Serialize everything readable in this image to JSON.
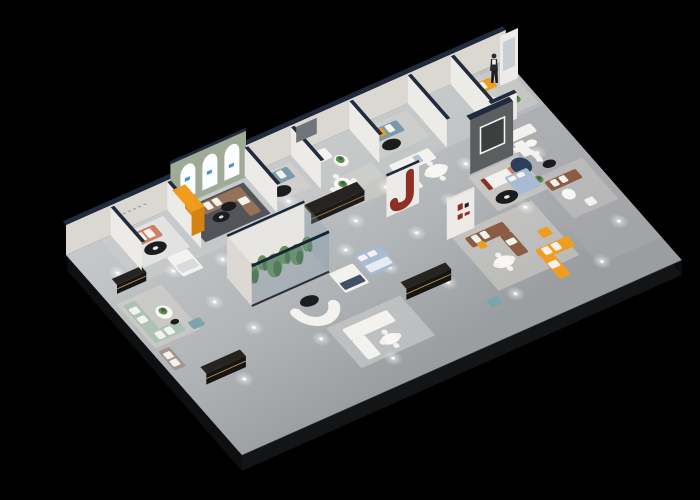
{
  "canvas": {
    "width": 700,
    "height": 500,
    "background": "#000000"
  },
  "scene_type": "3d-isometric-furniture-showroom-floor-plan",
  "palette": {
    "floor": "#b3b6b8",
    "floor_light": "#ced1d1",
    "floor_dark": "#9b9ea1",
    "slab_edge": "#121416",
    "slab_top_line": "#34383c",
    "wall_face": "#dbd8d2",
    "wall_bright": "#edebe7",
    "wall_cap_navy": "#202b3d",
    "wall_cap_light": "#e6e3de",
    "sage_wall": "#9fab97",
    "arch_white": "#fcfdff",
    "arch_logo_blue": "#2e7fc2",
    "glass": "rgba(136,158,173,0.30)",
    "glass_dark": "rgba(90,110,125,0.45)",
    "glass_cap_navy": "#182539",
    "glass_highlight": "#d8e6ee",
    "orange": "#f09c1e",
    "coral": "#cf7f63",
    "mauve": "#a5948b",
    "brown": "#96715a",
    "leather_brown": "#8a5d42",
    "steel_blue": "#7b9aa9",
    "sage_green": "#abc2b4",
    "teal": "#7aa6ab",
    "navy_table": "#2d3e5a",
    "red_accent": "#8e2f26",
    "dark_wood": "#262320",
    "gold_trim": "#c9a14d",
    "white_fabric": "#f3f2ef",
    "cushion_white": "#f8f7f4",
    "rug_dark": "#46474c",
    "rug_light": "#d9d6d0",
    "rug_gray": "#c3c5c5",
    "rug_blue": "#b0bfd2",
    "plant_green": "#5c8a50",
    "plant_dark": "#3e6a3d",
    "pot_dark": "#3a3a3a",
    "bed_blue": "#a7bcd2",
    "tv_wall": "#5b5d5f",
    "table_black": "#1b1c1e",
    "figure_dark": "#262a2f",
    "spot_core": "#ffffff"
  },
  "objects": {
    "showroom-floor": {
      "color": "floor"
    },
    "floor-slab-edge": {
      "color": "slab_edge"
    },
    "back-wall": {
      "color": "wall_face"
    },
    "partition-wall": {
      "color": "wall_bright"
    },
    "arch-display-wall": {
      "color": "sage_wall"
    },
    "display-arch": {
      "color": "arch_white"
    },
    "coral-sofa": {
      "color": "coral"
    },
    "orange-reception-counter": {
      "color": "orange"
    },
    "brown-sectional-sofa": {
      "color": "brown"
    },
    "blue-fabric-sofa": {
      "color": "steel_blue"
    },
    "white-loveseat": {
      "color": "white_fabric"
    },
    "white-sectional-sofa": {
      "color": "white_fabric"
    },
    "curved-white-sofa": {
      "color": "white_fabric"
    },
    "round-dining-table": {
      "color": "cushion_white"
    },
    "rect-dining-table": {
      "color": "cushion_white"
    },
    "coffee-table-black": {
      "color": "table_black"
    },
    "corner-room-orange-sofa": {
      "color": "orange"
    },
    "promo-poster-panel": {
      "color": "wall_bright"
    },
    "staff-figure": {
      "color": "figure_dark"
    },
    "terrarium-display-case": {
      "color": "glass"
    },
    "terrarium-plants": {
      "color": "plant_green"
    },
    "media-console-dark": {
      "color": "dark_wood"
    },
    "display-counter-dark": {
      "color": "dark_wood"
    },
    "tv-feature-wall": {
      "color": "tv_wall"
    },
    "red-white-sofa": {
      "color": "white_fabric"
    },
    "navy-round-table": {
      "color": "navy_table"
    },
    "red-j-sculpture-wall": {
      "color": "red_accent"
    },
    "brand-sign-wall": {
      "color": "wall_bright"
    },
    "sage-green-sofa": {
      "color": "sage_green"
    },
    "teal-chaise": {
      "color": "teal"
    },
    "teal-ottoman": {
      "color": "teal"
    },
    "mauve-sofa": {
      "color": "mauve"
    },
    "white-bed": {
      "color": "white_fabric"
    },
    "blue-bed": {
      "color": "bed_blue"
    },
    "leather-sofa-brown": {
      "color": "leather_brown"
    },
    "orange-sectional-sofa": {
      "color": "orange"
    },
    "orange-armchair": {
      "color": "orange"
    },
    "white-armchair": {
      "color": "white_fabric"
    },
    "glass-facade": {
      "color": "glass"
    },
    "glass-partition": {
      "color": "glass_dark"
    },
    "ceiling-spotlight": {
      "color": "spot_core"
    },
    "plant": {
      "color": "plant_green"
    }
  }
}
